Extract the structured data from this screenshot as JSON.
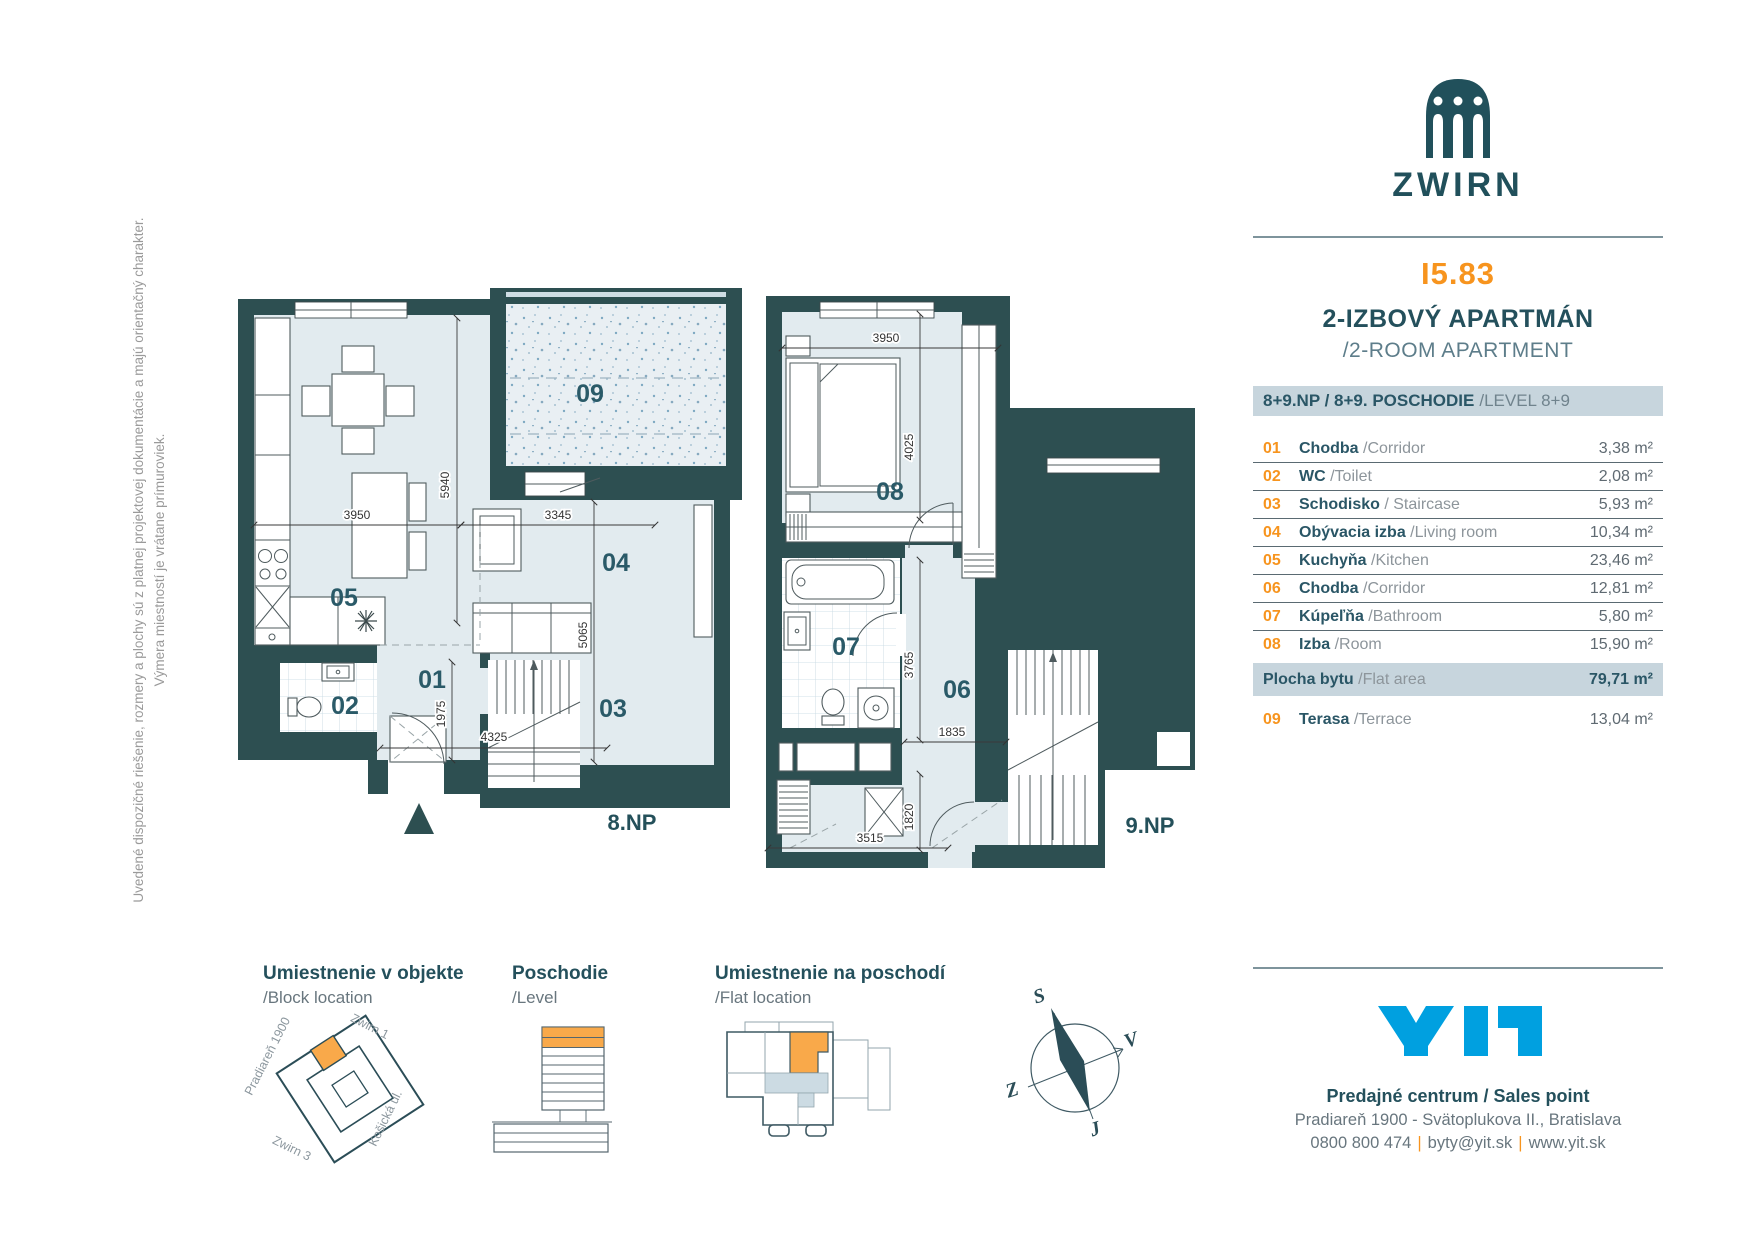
{
  "disclaimer": {
    "line1": "Uvedené dispozičné riešenie, rozmery a plochy sú z platnej projektovej dokumentácie a majú orientačný charakter.",
    "line2": "Výmera miestností je vrátane prímuroviek."
  },
  "brand": {
    "name": "ZWIRN",
    "unit_id": "I5.83",
    "type_sk": "2-IZBOVÝ APARTMÁN",
    "type_en": "/2-ROOM APARTMENT"
  },
  "legend": {
    "header_bold": "8+9.NP / 8+9. POSCHODIE",
    "header_light": "/LEVEL 8+9",
    "rows": [
      {
        "num": "01",
        "sk": "Chodba",
        "en": "/Corridor",
        "area": "3,38 m²"
      },
      {
        "num": "02",
        "sk": "WC",
        "en": "/Toilet",
        "area": "2,08 m²"
      },
      {
        "num": "03",
        "sk": "Schodisko",
        "en": "/ Staircase",
        "area": "5,93 m²"
      },
      {
        "num": "04",
        "sk": "Obývacia izba",
        "en": "/Living room",
        "area": "10,34 m²"
      },
      {
        "num": "05",
        "sk": "Kuchyňa",
        "en": "/Kitchen",
        "area": "23,46 m²"
      },
      {
        "num": "06",
        "sk": "Chodba",
        "en": "/Corridor",
        "area": "12,81 m²"
      },
      {
        "num": "07",
        "sk": "Kúpeľňa",
        "en": "/Bathroom",
        "area": "5,80 m²"
      },
      {
        "num": "08",
        "sk": "Izba",
        "en": "/Room",
        "area": "15,90 m²"
      }
    ],
    "total": {
      "sk": "Plocha bytu",
      "en": "/Flat area",
      "area": "79,71 m²"
    },
    "terrace": {
      "num": "09",
      "sk": "Terasa",
      "en": "/Terrace",
      "area": "13,04 m²"
    }
  },
  "plans": {
    "left": {
      "floor": "8.NP",
      "rooms": {
        "r01": "01",
        "r02": "02",
        "r03": "03",
        "r04": "04",
        "r05": "05",
        "r09": "09"
      },
      "dims": {
        "kitchen_w": "3950",
        "kitchen_h": "5940",
        "living_w": "3345",
        "living_h": "5065",
        "entry_h": "1975",
        "bottom_w": "4325"
      }
    },
    "right": {
      "floor": "9.NP",
      "rooms": {
        "r06": "06",
        "r07": "07",
        "r08": "08"
      },
      "dims": {
        "bed_w": "3950",
        "bed_h": "4025",
        "corr_h": "3765",
        "corr_w": "1835",
        "store_h": "1820",
        "bottom_w": "3515"
      }
    }
  },
  "diagrams": {
    "block": {
      "title": "Umiestnenie v objekte",
      "subtitle": "/Block location",
      "labels": {
        "nw": "Pradiareň 1900",
        "ne": "Zwirn 1",
        "se": "Košická ul.",
        "sw": "Zwirn 3"
      }
    },
    "level": {
      "title": "Poschodie",
      "subtitle": "/Level"
    },
    "flat": {
      "title": "Umiestnenie na poschodí",
      "subtitle": "/Flat location"
    },
    "compass": {
      "n": "S",
      "e": "V",
      "s": "J",
      "w": "Z"
    }
  },
  "footer": {
    "brand": "YIT",
    "line1": "Predajné centrum / Sales point",
    "line2": "Pradiareň 1900 - Svätoplukova II., Bratislava",
    "phone": "0800 800 474",
    "email": "byty@yit.sk",
    "web": "www.yit.sk",
    "sep": "|"
  },
  "colors": {
    "wall_teal": "#2d4f51",
    "brand_teal": "#21505b",
    "accent_orange": "#f7941e",
    "bar_bg": "#c7d5dd",
    "room_fill": "#e2ebef",
    "yit_blue": "#00a0e0"
  }
}
